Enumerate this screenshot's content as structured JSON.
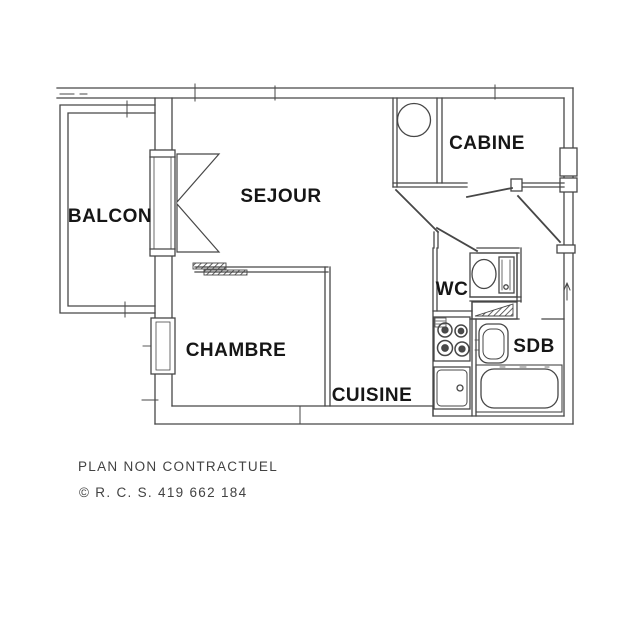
{
  "plan": {
    "line_color": "#474747",
    "label_color": "#161616",
    "footer_color": "#424242",
    "rooms": {
      "balcon": "BALCON",
      "sejour": "SEJOUR",
      "cabine": "CABINE",
      "wc": "WC",
      "sdb": "SDB",
      "chambre": "CHAMBRE",
      "cuisine": "CUISINE"
    },
    "fixtures": [
      "water-heater",
      "toilet",
      "shelf",
      "washbasin",
      "bathtub",
      "stove",
      "kitchen-sink",
      "french-door",
      "window",
      "sliding-door",
      "entrance-door",
      "cabine-door",
      "hall-door",
      "wc-door"
    ]
  },
  "footer": {
    "disclaimer": "PLAN NON CONTRACTUEL",
    "registration": "© R. C. S. 419 662 184"
  }
}
